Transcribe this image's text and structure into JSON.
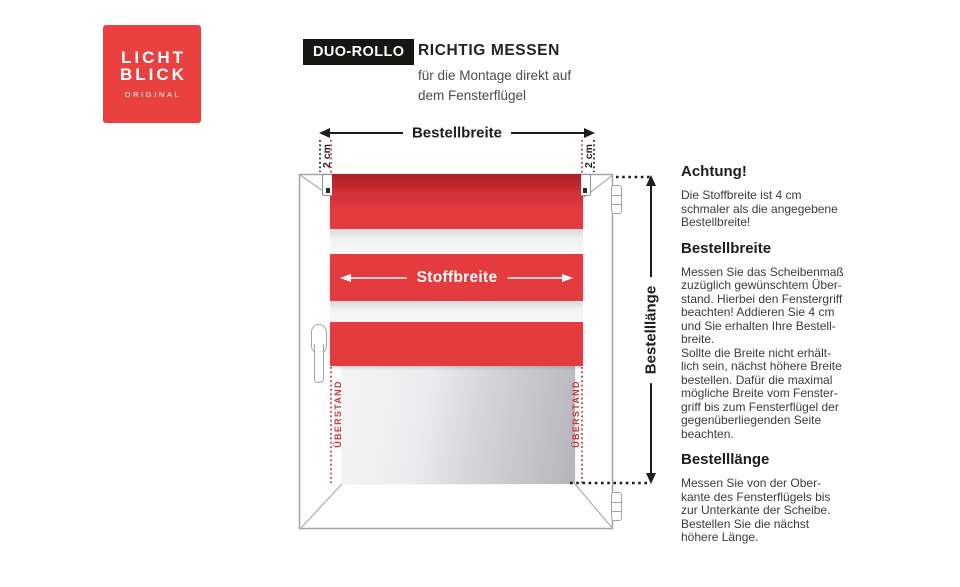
{
  "logo": {
    "wordmark": "LICHT\nBLICK",
    "tagline": "ORIGINAL"
  },
  "header": {
    "badge": "DUO-ROLLO",
    "title": "RICHTIG MESSEN",
    "subtitle": "für die Montage direkt auf\ndem Fensterflügel"
  },
  "diagram": {
    "bestellbreite_label": "Bestellbreite",
    "stoffbreite_label": "Stoffbreite",
    "bestelllaenge_label": "Bestelllänge",
    "offset_left": "2 cm",
    "offset_right": "2 cm",
    "ueberstand_left": "ÜBERSTAND",
    "ueberstand_right": "ÜBERSTAND"
  },
  "info": {
    "sections": [
      {
        "heading": "Achtung!",
        "body": "Die Stoffbreite ist 4 cm\nschmaler als die angegebene\nBestellbreite!"
      },
      {
        "heading": "Bestellbreite",
        "body": "Messen Sie das Scheibenmaß\nzuzüglich gewünschtem Über-\nstand. Hierbei den Fenstergriff\nbeachten! Addieren Sie 4 cm\nund Sie erhalten Ihre Bestell-\nbreite.\nSollte die Breite nicht erhält-\nlich sein, nächst höhere Breite\nbestellen. Dafür die maximal\nmögliche Breite vom Fenster-\ngriff bis zum Fensterflügel der\ngegenüberliegenden Seite\nbeachten."
      },
      {
        "heading": "Bestelllänge",
        "body": "Messen Sie von der Ober-\nkante des Fensterflügels bis\nzur Unterkante der Scheibe.\nBestellen Sie die nächst\nhöhere Länge."
      }
    ]
  },
  "colors": {
    "brand_red": "#e8413f",
    "blind_red": "#e43c3e",
    "roller_red": "#c1272d",
    "overhang_red": "#cb3437",
    "line_black": "#1d1d1b"
  }
}
